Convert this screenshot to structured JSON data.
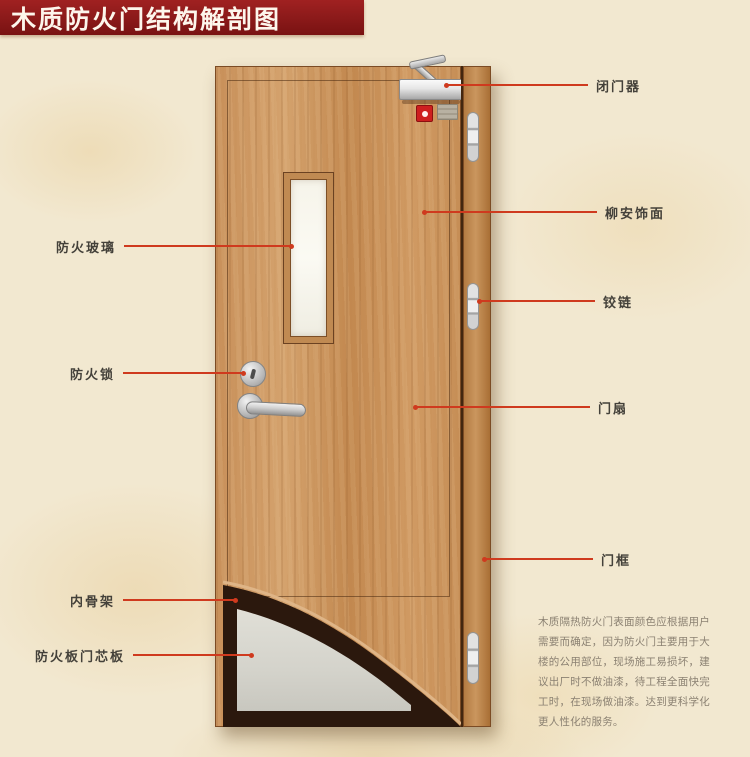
{
  "title": "木质防火门结构解剖图",
  "annotations": {
    "left": [
      {
        "text": "防火玻璃"
      },
      {
        "text": "防火锁"
      },
      {
        "text": "内骨架"
      },
      {
        "text": "防火板门芯板"
      }
    ],
    "right": [
      {
        "text": "闭门器"
      },
      {
        "text": "柳安饰面"
      },
      {
        "text": "铰链"
      },
      {
        "text": "门扇"
      },
      {
        "text": "门框"
      }
    ]
  },
  "description": "木质隔热防火门表面颜色应根据用户需要而确定，因为防火门主要用于大楼的公用部位，现场施工易损坏，建议出厂时不做油漆，待工程全面快完工时，在现场做油漆。达到更科学化更人性化的服务。",
  "colors": {
    "banner_red": "#8e1b1b",
    "annotation_line_red": "#cf3a1e",
    "door_wood": "#c8905a",
    "core_panel_gray": "#d8d7cf",
    "inner_frame_dark": "#2b180d",
    "background_parchment": "#f2e8d0",
    "glass_white": "#f8f6ee"
  }
}
